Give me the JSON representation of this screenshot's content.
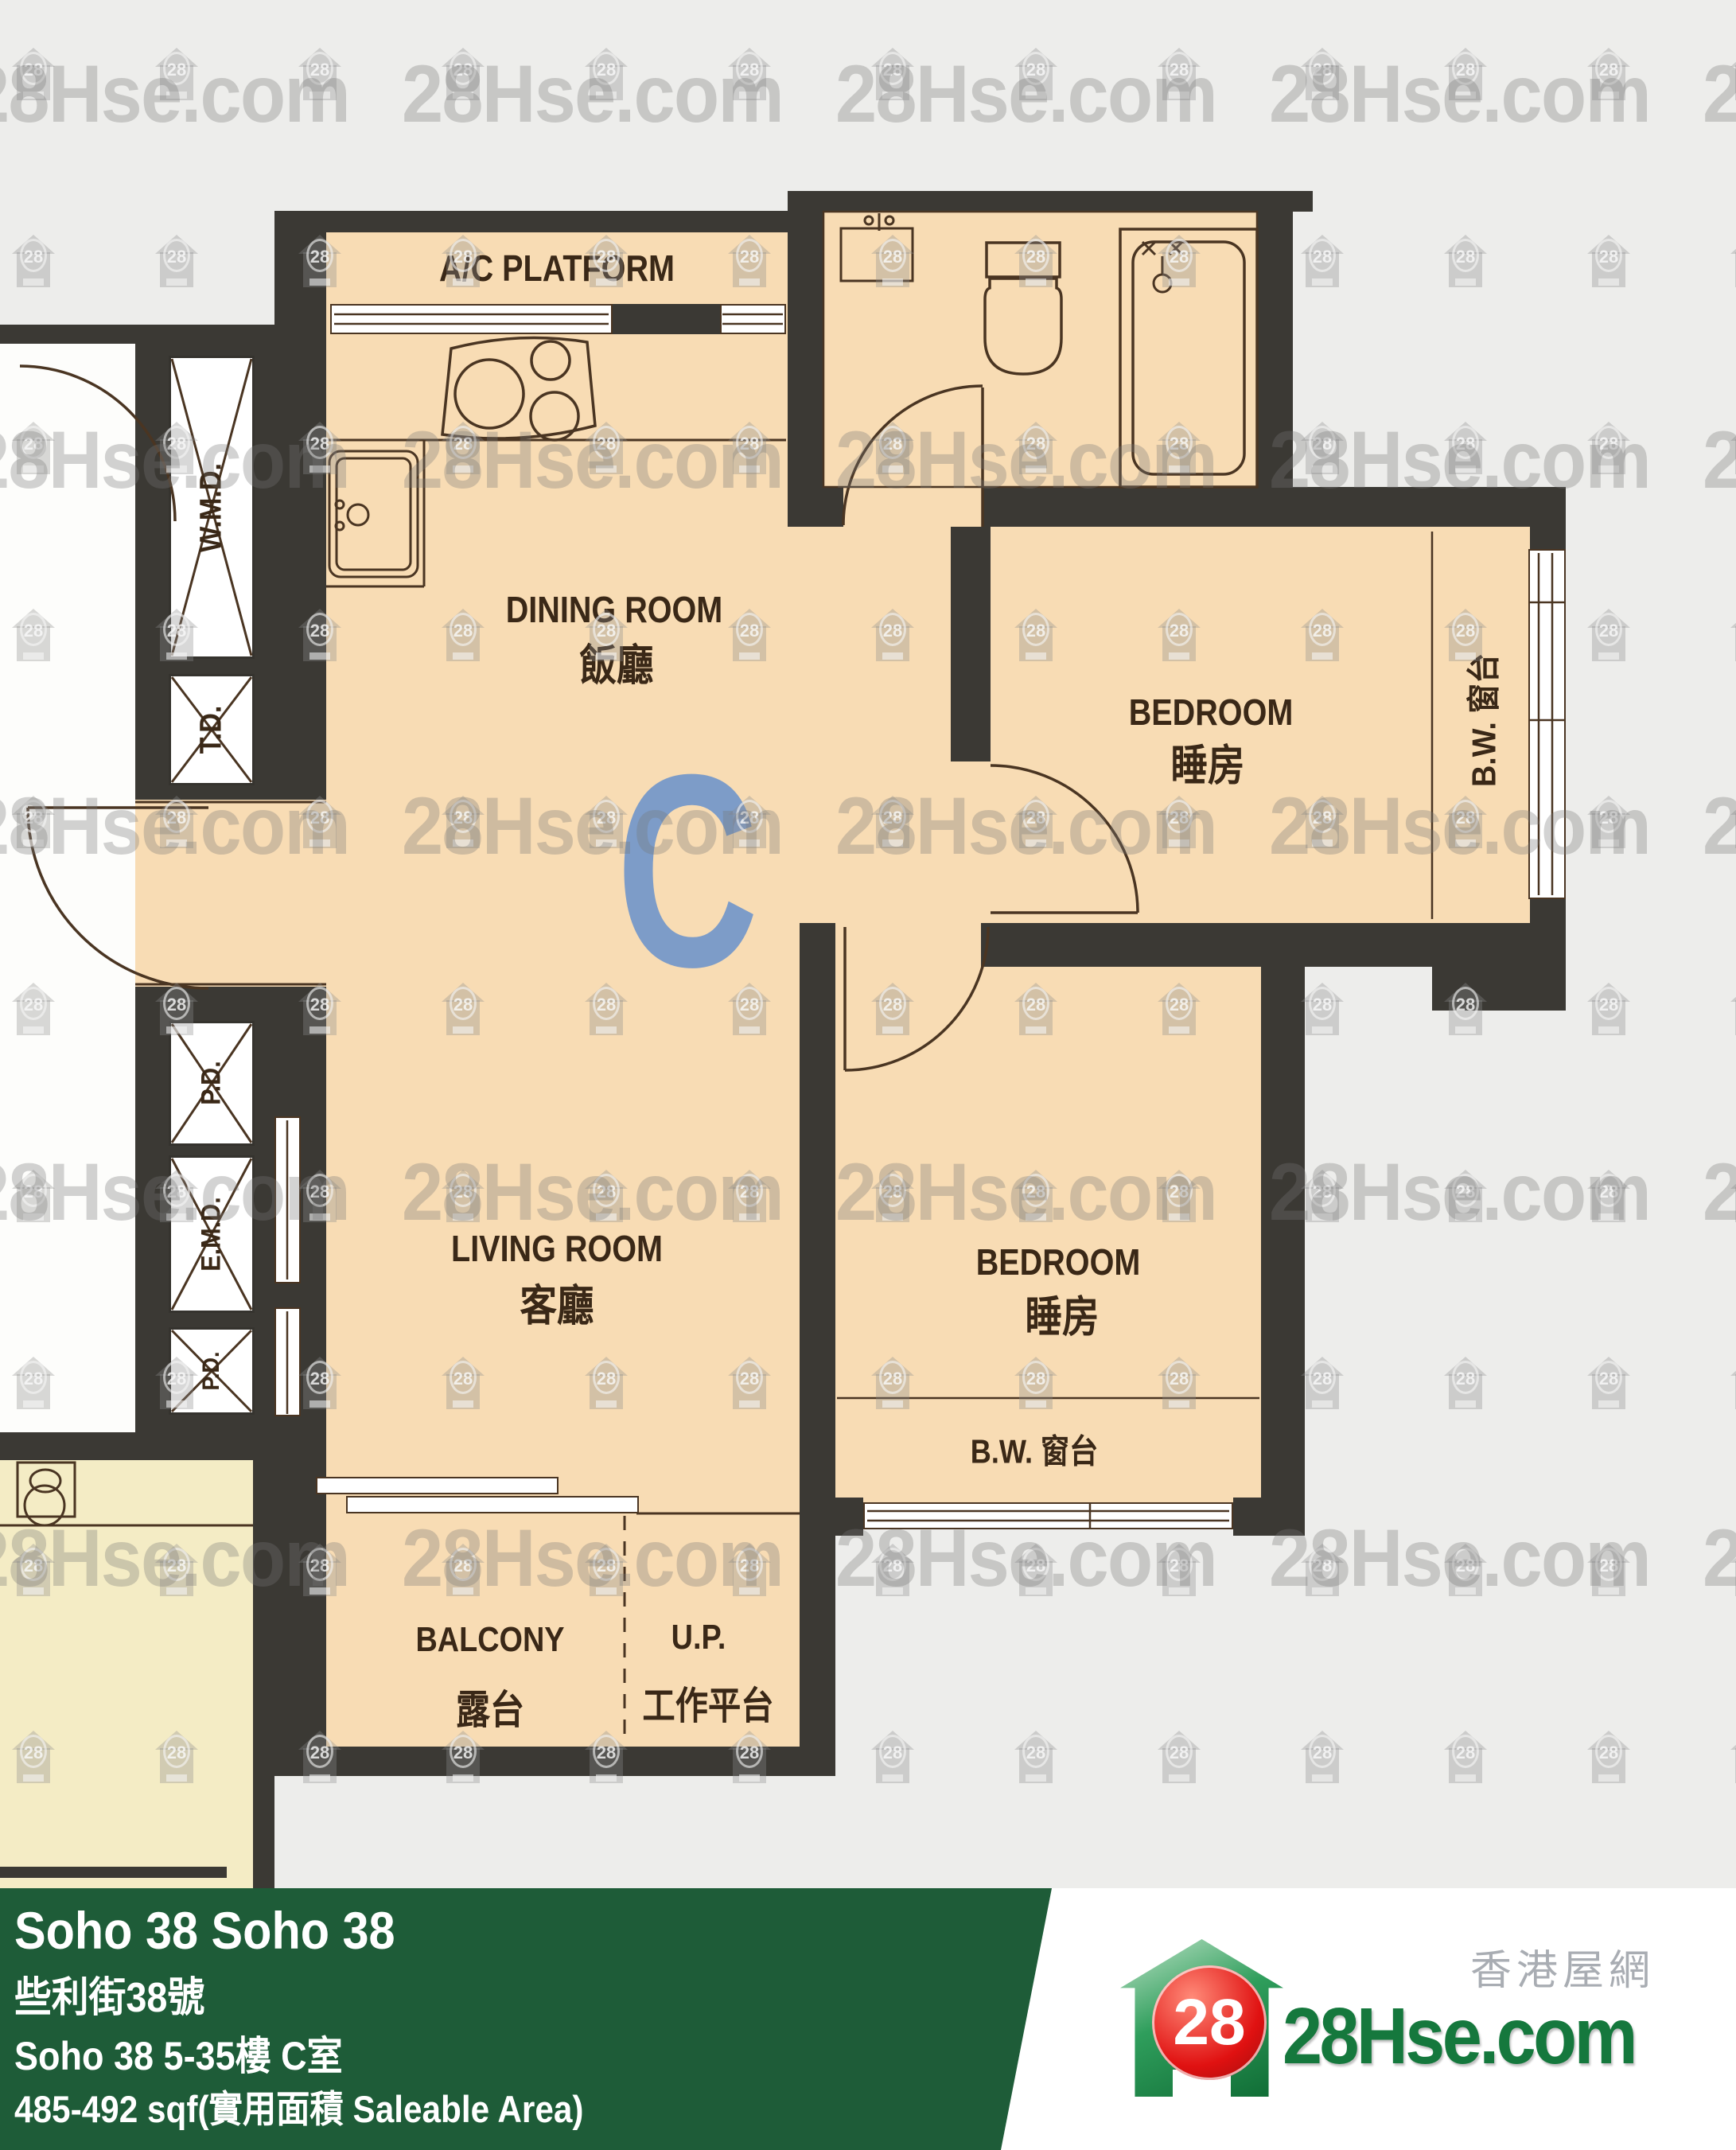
{
  "plan": {
    "unit_letter": "C",
    "labels": {
      "ac_platform": "A/C PLATFORM",
      "dining_en": "DINING ROOM",
      "dining_cn": "飯廳",
      "bedroom1_en": "BEDROOM",
      "bedroom1_cn": "睡房",
      "bedroom2_en": "BEDROOM",
      "bedroom2_cn": "睡房",
      "living_en": "LIVING ROOM",
      "living_cn": "客廳",
      "balcony_en": "BALCONY",
      "balcony_cn": "露台",
      "up_en": "U.P.",
      "up_cn": "工作平台",
      "bw_bedroom1": "B.W. 窗台",
      "bw_bedroom2": "B.W. 窗台",
      "shaft_wmd": "W.M.D.",
      "shaft_td": "T.D.",
      "shaft_pd_top": "P.D.",
      "shaft_emd": "E.M.D.",
      "shaft_pd_bottom": "P.D."
    }
  },
  "watermark": {
    "text": "28Hse.com",
    "badge": "28"
  },
  "banner": {
    "title": "Soho 38 Soho 38",
    "address_cn": "些利街38號",
    "floor_unit": "Soho 38 5-35樓 C室",
    "area": "485-492 sqf(實用面積 Saleable Area)",
    "background_color": "#1e5c38"
  },
  "logo": {
    "badge": "28",
    "site": "28Hse.com",
    "tagline_cn": "香港屋網",
    "green": "#15783d",
    "red": "#d51111"
  },
  "colors": {
    "wall": "#3b3934",
    "room_fill": "#f8dcb4",
    "neighbor_fill": "#f4ecc5",
    "lobby_white": "#fdfdfb",
    "unit_letter_blue": "#7d9cc8",
    "line_brown": "#4a3522",
    "background": "#ededeb"
  }
}
